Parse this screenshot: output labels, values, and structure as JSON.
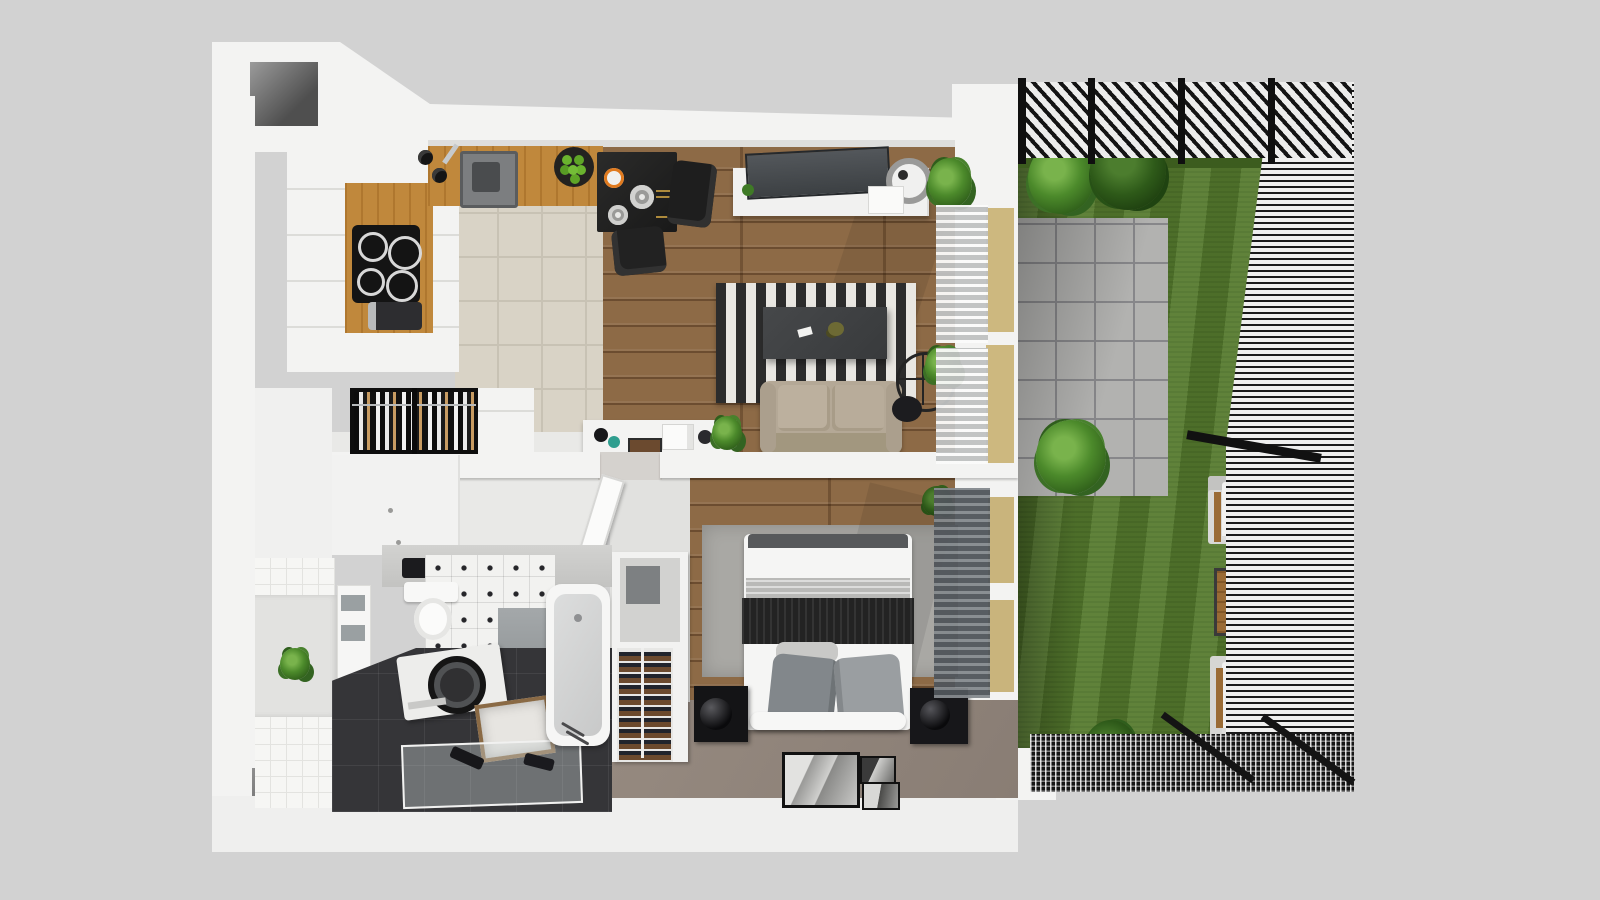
{
  "scene": {
    "title": "3D top-down cutaway floor plan of a one-bedroom apartment with garden terrace",
    "view": "top-down 3D render, no visible text labels",
    "background_color": "#d2d2d2"
  },
  "palette": {
    "background": "#d2d2d2",
    "wall_white": "#f3f3f2",
    "wood_floor": "#8d6a46",
    "oak_counter": "#c0883c",
    "beige_tile": "#d9d3c6",
    "white_tile": "#f6f6f4",
    "dark_tile": "#353538",
    "taupe_floor": "#8c7f76",
    "grass_green": "#567a2e",
    "paver_gray": "#b2b2b0",
    "structure_black": "#161616",
    "rug_dark": "#2c2c2c",
    "rug_light": "#e9e7e2",
    "sofa_beige": "#b4a896",
    "window_tan": "#cdb87f",
    "bedroom_rug_gray": "#a9a8a4",
    "blanket_black": "#232323"
  },
  "rooms": [
    {
      "id": "kitchen",
      "label": "Kitchen",
      "furniture": [
        "white cabinet run",
        "oak worktop inset",
        "induction cooktop",
        "coffee machine",
        "oak counter with sink",
        "faucet",
        "fruit bowl with green apples",
        "pepper mills"
      ]
    },
    {
      "id": "dining",
      "label": "Dining area",
      "furniture": [
        "black square table",
        "set tableware with plates and oranges",
        "two black chairs"
      ]
    },
    {
      "id": "living",
      "label": "Living room",
      "furniture": [
        "white TV sideboard",
        "flat TV leaning on wall",
        "round lamp",
        "corner plant",
        "black and white striped rug",
        "dark coffee table",
        "beige two-seat sofa",
        "tripod floor lamp",
        "white desk with coffee maker and tablet",
        "desk plant"
      ]
    },
    {
      "id": "hall",
      "label": "Hallway / wardrobe",
      "furniture": [
        "open wardrobe with hanging clothes",
        "white closet front",
        "interior door leaf (open)"
      ]
    },
    {
      "id": "bathroom",
      "label": "Bathroom",
      "furniture": [
        "gray vanity counter with black sink",
        "wall-hung toilet",
        "towel shelf",
        "niche plant",
        "top-load washing machine",
        "wooden laundry hamper",
        "glass shower screen with towels",
        "bathtub"
      ]
    },
    {
      "id": "bedroom",
      "label": "Bedroom",
      "furniture": [
        "double bed with black throw and gray pillows",
        "gray area rug",
        "two black nightstands with sphere lamps",
        "shelf unit with open cabinet and bottle rack",
        "three picture frames on floor"
      ]
    }
  ],
  "garden": {
    "label": "Garden terrace",
    "features": [
      "black slatted pergola",
      "black mesh fence with posts",
      "lawn",
      "stone paver patio",
      "two leafy plants",
      "small tree",
      "dark bush",
      "two lounge chairs with white cushions",
      "wooden side table",
      "steel grate walkway",
      "diagonal rails"
    ]
  },
  "structure": {
    "walls": "thick white cutaway walls",
    "openings": [
      "top-left wall recess",
      "bottom-left wall recess",
      "four tan glazed windows to garden",
      "white venetian blinds (living)",
      "gray venetian blinds (bedroom)"
    ]
  }
}
